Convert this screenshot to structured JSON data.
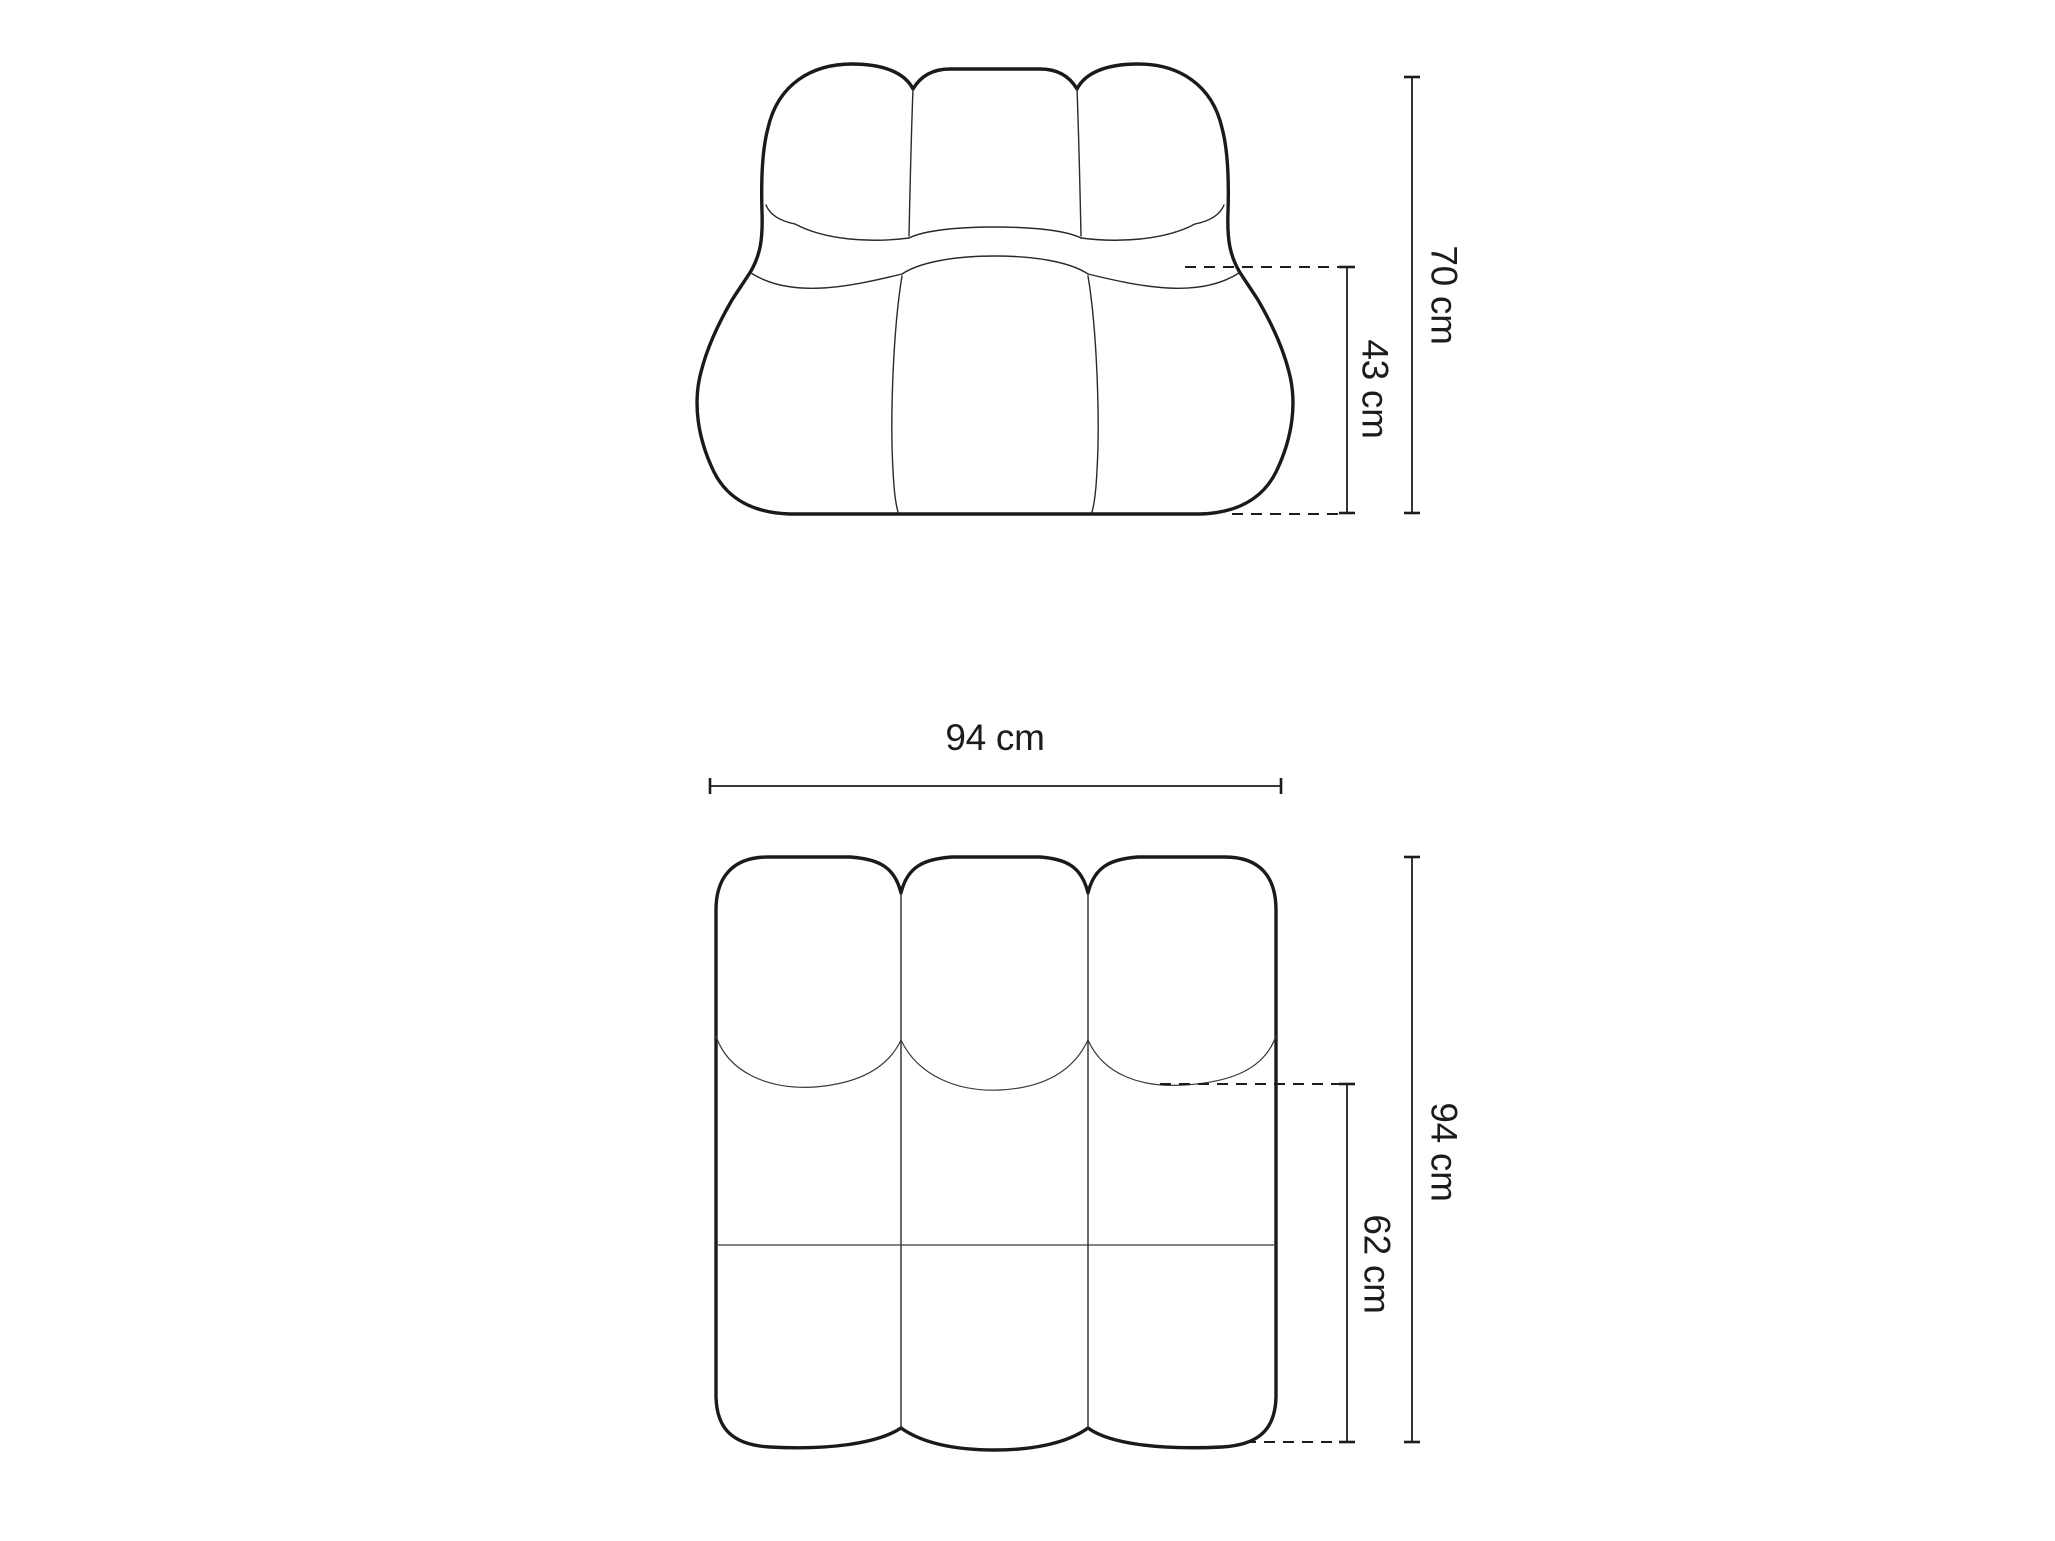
{
  "page": {
    "background_color": "#ffffff",
    "line_color": "#1a1a1a",
    "text_color": "#1c1c1c"
  },
  "front_view": {
    "view": "front elevation of modular sofa seat element",
    "dimensions": {
      "overall_height": {
        "label": "70 cm"
      },
      "seat_height": {
        "label": "43 cm"
      }
    }
  },
  "top_view": {
    "view": "top plan of modular sofa seat element",
    "dimensions": {
      "overall_width": {
        "label": "94 cm"
      },
      "overall_depth": {
        "label": "94 cm"
      },
      "seat_depth": {
        "label": "62 cm"
      }
    }
  }
}
